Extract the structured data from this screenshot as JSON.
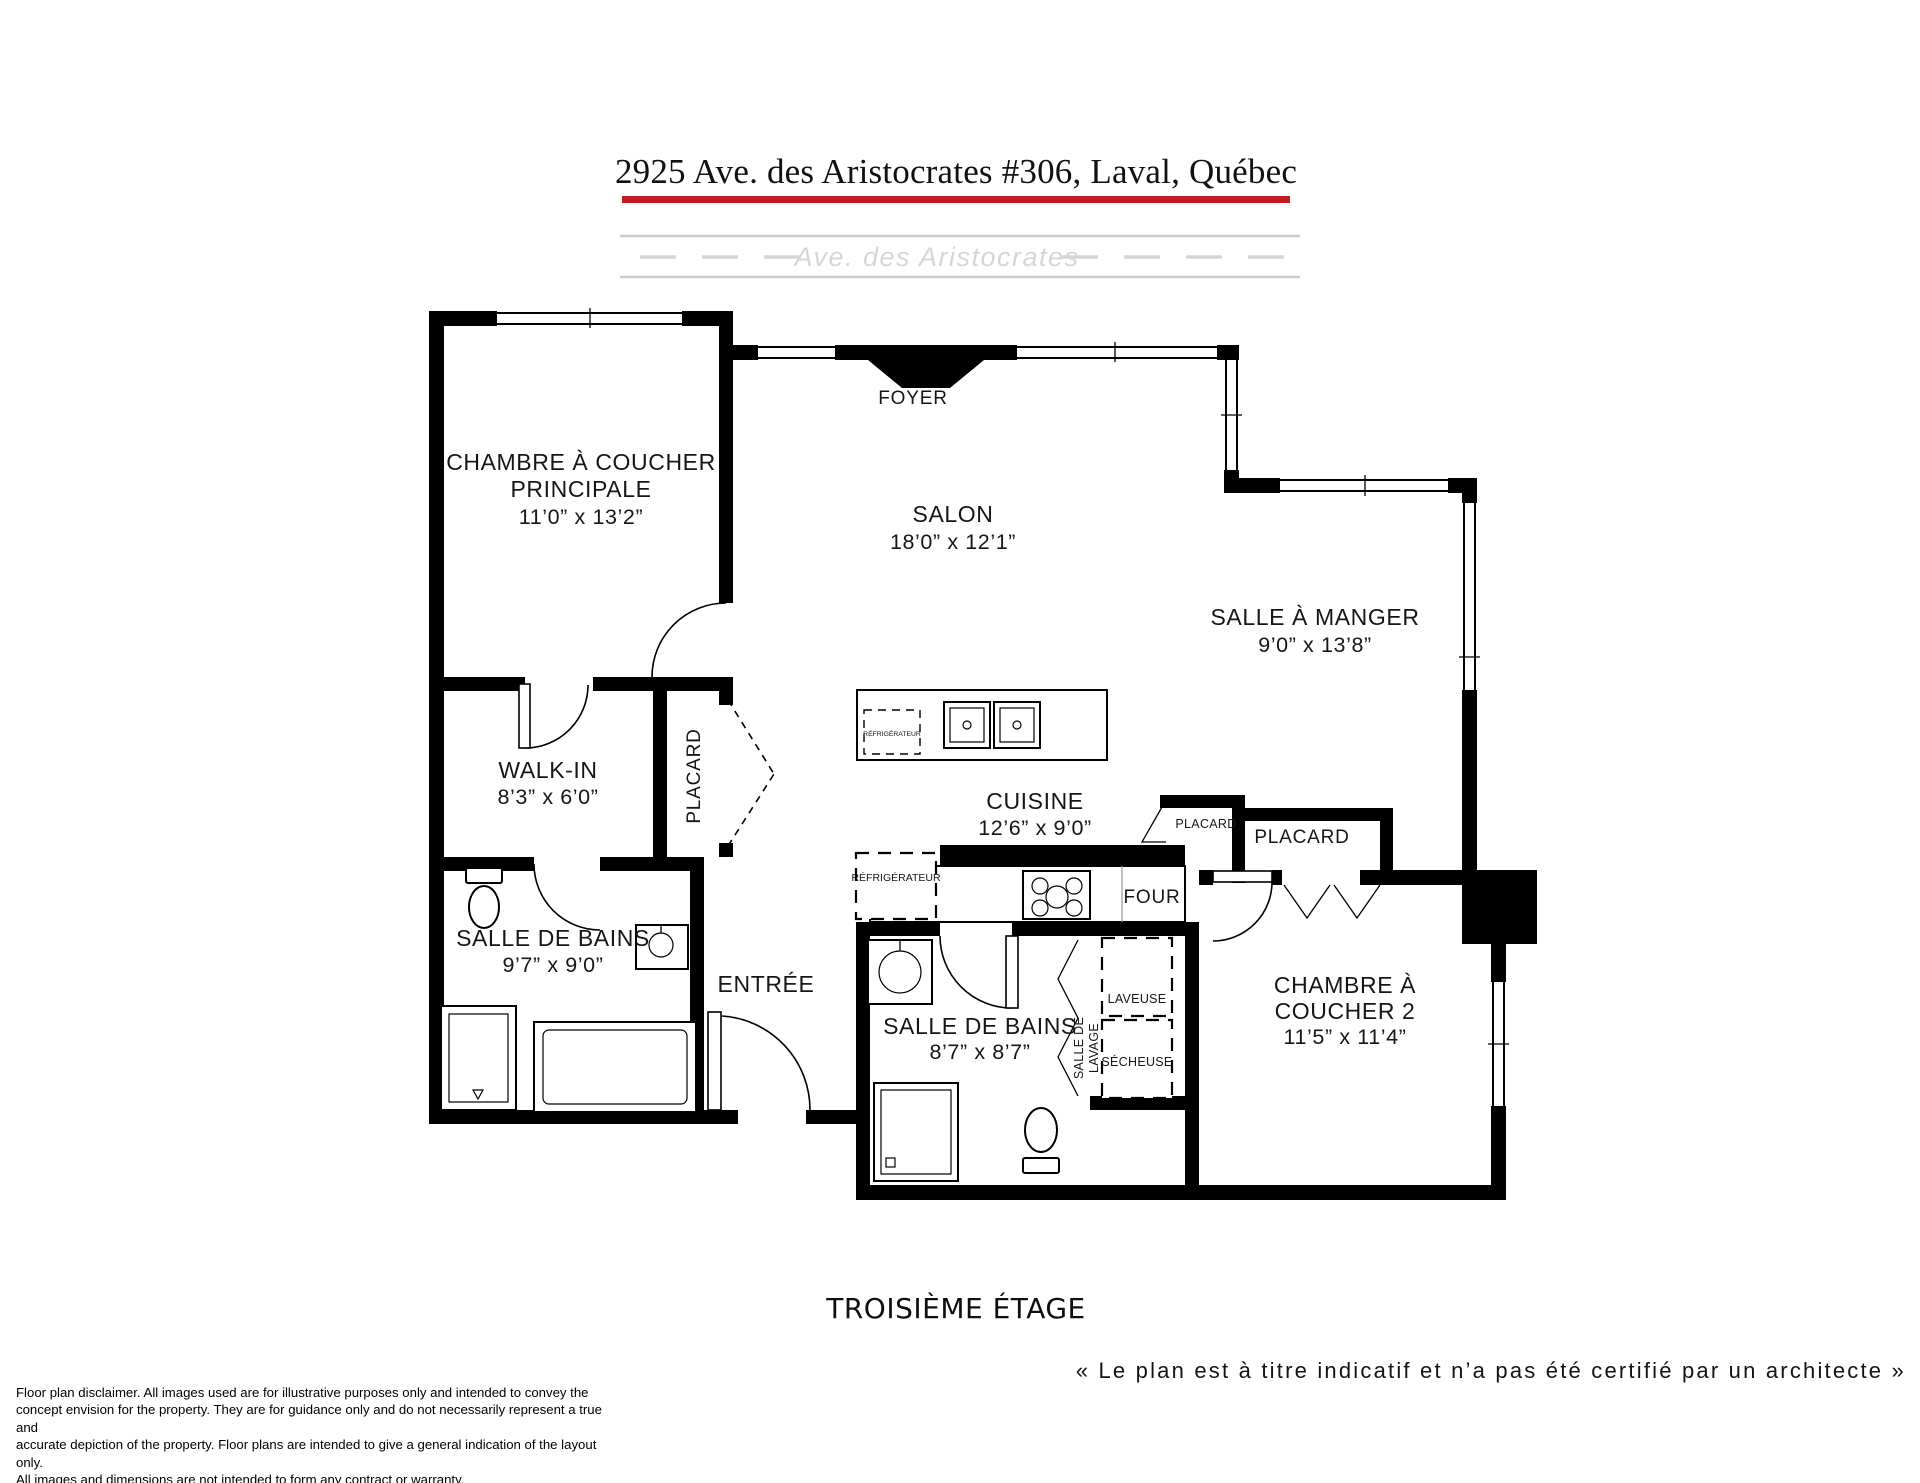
{
  "header": {
    "title": "2925 Ave. des Aristocrates #306, Laval, Québec",
    "underline_color": "#c11b24"
  },
  "street": {
    "label": "Ave. des Aristocrates"
  },
  "rooms": {
    "foyer": {
      "name": "FOYER"
    },
    "master": {
      "name_line1": "CHAMBRE À COUCHER",
      "name_line2": "PRINCIPALE",
      "dims": "11’0” x 13’2”"
    },
    "salon": {
      "name": "SALON",
      "dims": "18’0” x 12’1”"
    },
    "dining": {
      "name": "SALLE À MANGER",
      "dims": "9’0” x 13’8”"
    },
    "walkin": {
      "name": "WALK-IN",
      "dims": "8’3” x 6’0”"
    },
    "placard_master": {
      "name": "PLACARD"
    },
    "bath1": {
      "name": "SALLE DE BAINS",
      "dims": "9’7” x 9’0”"
    },
    "entree": {
      "name": "ENTRÉE"
    },
    "cuisine": {
      "name": "CUISINE",
      "dims": "12’6” x 9’0”"
    },
    "bath2": {
      "name": "SALLE DE BAINS",
      "dims": "8’7” x 8’7”"
    },
    "laundry": {
      "name_line1": "SALLE DE",
      "name_line2": "LAVAGE",
      "washer": "LAVEUSE",
      "dryer": "SÉCHEUSE"
    },
    "bedroom2": {
      "name_line1": "CHAMBRE À",
      "name_line2": "COUCHER 2",
      "dims": "11’5” x 11’4”"
    },
    "placard_small": {
      "name": "PLACARD"
    },
    "placard_bedroom2": {
      "name": "PLACARD"
    },
    "fridge": {
      "name": "RÉFRIGÉRATEUR"
    },
    "island_fridge": {
      "name": "RÉFRIGÉRATEUR"
    },
    "oven": {
      "name": "FOUR"
    }
  },
  "footer": {
    "floor": "TROISIÈME ÉTAGE",
    "quote": "« Le plan est à titre indicatif et n’a pas été certifié par un architecte »",
    "disclaimer_lines": [
      "Floor plan disclaimer. All images used are for illustrative purposes only and intended to convey the",
      "concept envision for the property. They are for guidance only and do not necessarily represent a true and",
      "accurate depiction of the property. Floor plans are intended to give a general indication of the layout only.",
      "All images and dimensions are not intended to form any contract or warranty."
    ]
  }
}
